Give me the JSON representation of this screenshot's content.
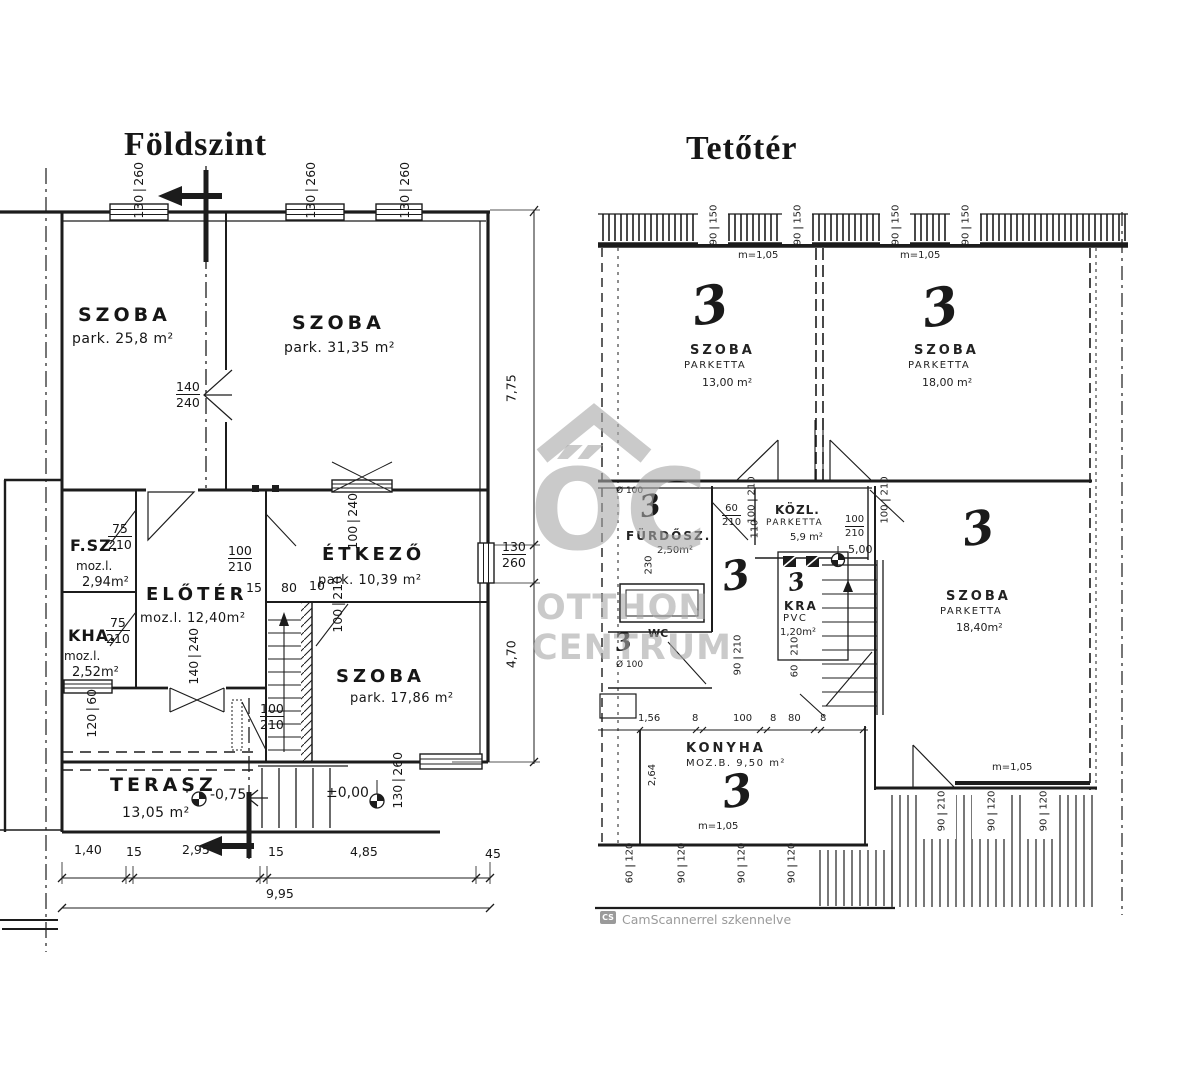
{
  "ground_floor": {
    "title": "Földszint",
    "rooms": {
      "szoba1": {
        "name": "SZOBA",
        "area": "park. 25,8 m²"
      },
      "szoba2": {
        "name": "SZOBA",
        "area": "park. 31,35 m²"
      },
      "fsz": {
        "name": "F.SZ.",
        "material": "moz.l.",
        "area": "2,94m²",
        "door_w": "75",
        "door_h": "210"
      },
      "kha": {
        "name": "KHA.",
        "material": "moz.l.",
        "area": "2,52m²",
        "door_w": "75",
        "door_h": "210"
      },
      "eloter": {
        "name": "ELŐTÉR",
        "area": "moz.l. 12,40m²"
      },
      "etkezo": {
        "name": "ÉTKEZŐ",
        "area": "park. 10,39 m²"
      },
      "szoba3": {
        "name": "SZOBA",
        "area": "park. 17,86 m²"
      },
      "terasz": {
        "name": "TERASZ",
        "area": "13,05 m²"
      }
    },
    "windows": {
      "top1": {
        "w": "130",
        "h": "260"
      },
      "top2": {
        "w": "130",
        "h": "260"
      },
      "top3": {
        "w": "130",
        "h": "260"
      },
      "inner1": {
        "w": "140",
        "h": "240"
      },
      "etkezo_top": {
        "w": "100",
        "h": "240"
      },
      "right": {
        "w": "130",
        "h": "260"
      },
      "kha_bottom": {
        "w": "120",
        "h": "60"
      },
      "szoba3_bottom": {
        "w": "130",
        "h": "260"
      },
      "eloter_bottom": {
        "w": "140",
        "h": "240"
      }
    },
    "doors": {
      "eloter_etkezo": {
        "w": "100",
        "h": "210"
      },
      "szoba3": {
        "w": "100",
        "h": "210"
      },
      "entry": {
        "w": "100",
        "h": "210"
      },
      "gap15": "15",
      "gap80": "80",
      "gap10": "10"
    },
    "levels": {
      "terasz": "-0,75",
      "entry": "±0,00"
    },
    "dim_right": {
      "upper": "7,75",
      "win_w": "130",
      "win_h": "260",
      "lower": "4,70"
    },
    "dim_bottom": {
      "segments": [
        "1,40",
        "15",
        "2,95",
        "15",
        "4,85",
        "45"
      ],
      "total": "9,95"
    }
  },
  "attic": {
    "title": "Tetőtér",
    "mark": "3",
    "level": "5,00",
    "rooms": {
      "szoba1": {
        "name": "SZOBA",
        "finish": "PARKETTA",
        "area": "13,00 m²",
        "height": "m=1,05"
      },
      "szoba2": {
        "name": "SZOBA",
        "finish": "PARKETTA",
        "area": "18,00 m²",
        "height": "m=1,05"
      },
      "furdosz": {
        "name": "FÜRDŐSZ.",
        "area": "2,50m²",
        "pipe": "Ø 100",
        "depth": "230",
        "door_w": "60",
        "door_h": "210"
      },
      "kozl": {
        "name": "KÖZL.",
        "finish": "PARKETTA",
        "area": "5,9 m²"
      },
      "kra": {
        "name": "KRA",
        "finish": "PVC",
        "area": "1,20m²",
        "door_w": "60",
        "door_h": "210"
      },
      "wc": {
        "name": "WC",
        "pipe": "Ø 100"
      },
      "konyha": {
        "name": "KONYHA",
        "area": "MOZ.B. 9,50 m²",
        "height": "m=1,05",
        "depth": "2,64"
      },
      "szoba3": {
        "name": "SZOBA",
        "finish": "PARKETTA",
        "area": "18,40m²",
        "height": "m=1,05"
      }
    },
    "dims": {
      "top": [
        {
          "w": "90",
          "h": "150"
        },
        {
          "w": "90",
          "h": "150"
        },
        {
          "w": "90",
          "h": "150"
        },
        {
          "w": "90",
          "h": "150"
        }
      ],
      "kozl_left": {
        "w": "100",
        "h": "210"
      },
      "kozl_gap": "110",
      "kozl_right": {
        "w": "100",
        "h": "210"
      },
      "szoba2_door": {
        "w": "100",
        "h": "210"
      },
      "mid_door": {
        "w": "90",
        "h": "210"
      },
      "konyha_chain": [
        "1,56",
        "8",
        "100",
        "8",
        "80",
        "8"
      ],
      "bottom": [
        {
          "w": "60",
          "h": "120"
        },
        {
          "w": "90",
          "h": "120"
        },
        {
          "w": "90",
          "h": "120"
        },
        {
          "w": "90",
          "h": "120"
        }
      ],
      "right": [
        {
          "w": "90",
          "h": "210"
        },
        {
          "w": "90",
          "h": "120"
        },
        {
          "w": "90",
          "h": "120"
        }
      ]
    }
  },
  "watermark": {
    "logo": "ŐC",
    "line1": "OTTHON",
    "line2": "CENTRUM"
  },
  "footer": {
    "badge": "CS",
    "note": "CamScannerrel szkennelve"
  }
}
